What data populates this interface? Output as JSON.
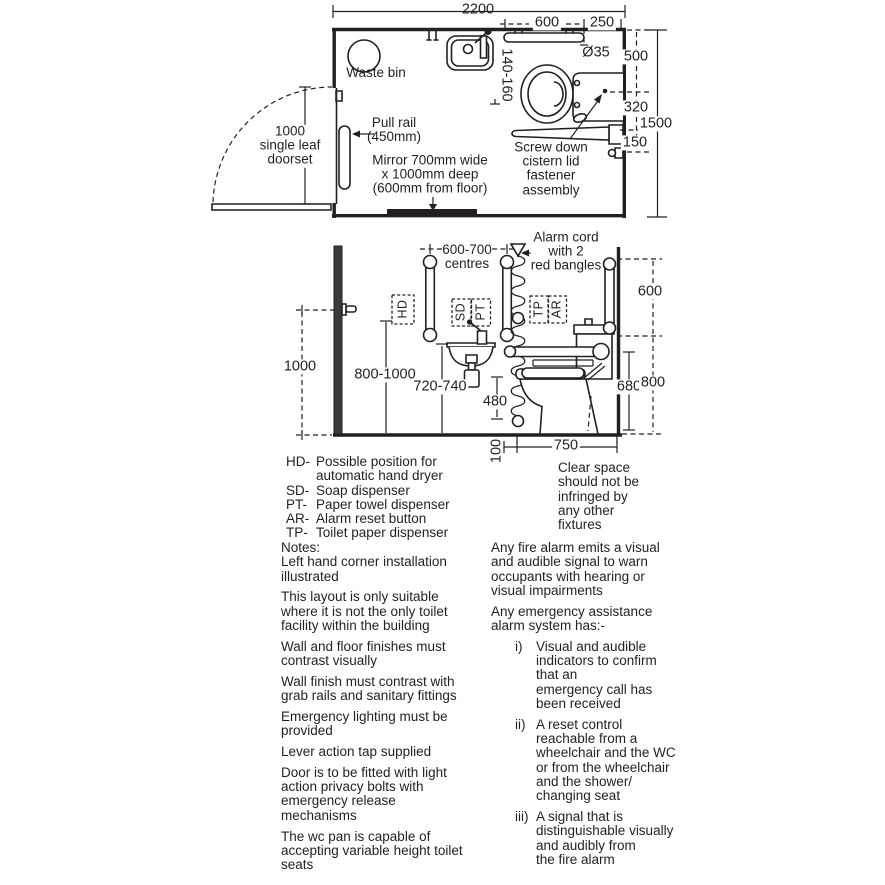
{
  "plan": {
    "dim_overall_width": "2200",
    "dim_rail_length": "600",
    "dim_rail_to_wall": "250",
    "dim_rail_diameter": "Ø35",
    "dim_basin_gap": "140-160",
    "dim_wall_to_cistern": "500",
    "dim_cistern_to_rail": "320",
    "dim_rail_to_bracket": "150",
    "dim_overall_depth": "1500",
    "label_waste_bin": "Waste bin",
    "label_pull_rail": "Pull rail\n(450mm)",
    "label_door": "1000\nsingle leaf\ndoorset",
    "label_mirror": "Mirror 700mm wide\nx 1000mm deep\n(600mm from floor)",
    "label_cistern": "Screw down\ncistern lid\nfastener\nassembly"
  },
  "elevation": {
    "dim_door_handle": "1000",
    "dim_rail_centres": "600-700\ncentres",
    "dim_hand_dryer": "800-1000",
    "dim_basin_height": "720-740",
    "dim_cord_ring": "480",
    "dim_cord_floor": "100",
    "dim_wc_front": "750",
    "dim_seat_height": "680",
    "dim_wall_rail_length": "600",
    "dim_wall_rail_height": "800",
    "label_alarm_cord": "Alarm cord\nwith 2\nred bangles",
    "tag_hd": "HD",
    "tag_sd": "SD",
    "tag_pt": "PT",
    "tag_tp": "TP",
    "tag_ar": "AR"
  },
  "legend": {
    "items": [
      {
        "abbr": "HD-",
        "desc": "Possible position for\nautomatic hand dryer"
      },
      {
        "abbr": "SD-",
        "desc": "Soap dispenser"
      },
      {
        "abbr": "PT-",
        "desc": "Paper towel dispenser"
      },
      {
        "abbr": "AR-",
        "desc": "Alarm reset button"
      },
      {
        "abbr": "TP-",
        "desc": "Toilet paper dispenser"
      }
    ]
  },
  "clear_space": "Clear space\nshould not be\ninfringed by\nany other\nfixtures",
  "notes_left": {
    "title": "Notes:",
    "paragraphs": [
      "Left hand corner installation\nillustrated",
      "This layout is only suitable\nwhere it is not the only toilet\nfacility within the building",
      "Wall and floor finishes must\ncontrast visually",
      "Wall finish must contrast with\ngrab rails and sanitary fittings",
      "Emergency lighting must be\nprovided",
      "Lever action tap supplied",
      "Door is to be fitted with light\naction privacy bolts with\nemergency release\nmechanisms",
      "The wc pan is capable of\naccepting variable height toilet\nseats"
    ]
  },
  "notes_right": {
    "paragraphs": [
      "Any fire alarm emits a visual\nand audible signal to warn\noccupants with hearing or\nvisual impairments",
      "Any emergency assistance\nalarm system has:-"
    ],
    "list": [
      {
        "num": "i)",
        "text": "Visual and audible\nindicators to confirm\nthat an\nemergency call has\nbeen received"
      },
      {
        "num": "ii)",
        "text": "A reset control\nreachable from a\nwheelchair and the WC\nor from the wheelchair\nand the shower/\nchanging seat"
      },
      {
        "num": "iii)",
        "text": "A signal that is\ndistinguishable visually\nand audibly from\nthe fire alarm"
      }
    ]
  },
  "colors": {
    "ink": "#231f20",
    "wall_fill": "#3b3b3b"
  }
}
